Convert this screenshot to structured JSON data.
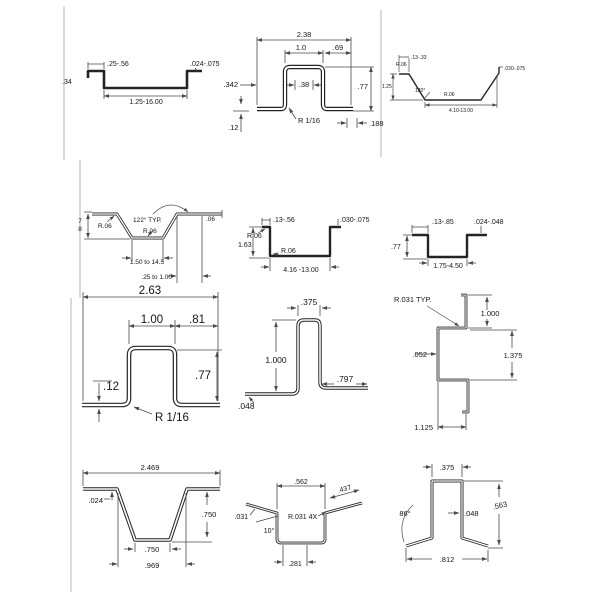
{
  "page": {
    "background": "#ffffff",
    "profile_color": "#242424",
    "dim_color": "#4a4a4a",
    "border_color": "#c6c6c6"
  },
  "cells": {
    "r1c1": {
      "flange_width": ".25-.56",
      "thickness": ".024-.075",
      "lip_height": ".34",
      "bottom_width": "1.25-16.00"
    },
    "r1c2": {
      "overall_width": "2.38",
      "top_width": "1.0",
      "right_offset": ".69",
      "left_offset": ".342",
      "inner_width": ".38",
      "height": ".77",
      "bend_radius": "R 1/16",
      "foot_length": ".188",
      "foot_height": ".12"
    },
    "r1c3": {
      "flange_width": ".13-.33",
      "radius_left": "R.06",
      "height": "1.25",
      "angle": "120°",
      "radius_right": "R.06",
      "thickness": ".030-.075",
      "bottom_width": "4.10-13.00"
    },
    "r2c1": {
      "height_numerator": "7",
      "height_denominator": "8",
      "radius_left": "R.06",
      "angle": "122° TYP.",
      "radius_center": "R.06",
      "thickness": ".06",
      "bottom_width": "1.50 to 14.5",
      "flange_width": ".25 to 1.00"
    },
    "r2c2": {
      "flange_width": ".13-.56",
      "thickness": ".030-.075",
      "radius_left": "R.06",
      "height": "1.63",
      "radius_inner": "R.06",
      "bottom_width": "4.16 -13.00"
    },
    "r2c3": {
      "flange_width": ".13-.85",
      "thickness": ".024-.048",
      "height": ".77",
      "bottom_width": "1.75-4.50"
    },
    "r3c1": {
      "overall_width": "2.63",
      "top_width": "1.00",
      "right_offset": ".81",
      "lip_height": ".12",
      "height": ".77",
      "bend_radius": "R 1/16"
    },
    "r3c2": {
      "top_width": ".375",
      "height": "1.000",
      "flange_length": ".797",
      "thickness": ".048"
    },
    "r3c3": {
      "bend_radius": "R.031 TYP.",
      "top_leg": "1.000",
      "thickness": ".052",
      "height": "1.375",
      "bottom_width": "1.125"
    },
    "r4c1": {
      "overall_width": "2.469",
      "thickness": ".024",
      "height": ".750",
      "bottom_inner": ".750",
      "bottom_outer": ".969"
    },
    "r4c2": {
      "top_width": ".562",
      "flange_length": ".437",
      "thickness": ".031",
      "angle": "10°",
      "bend_radius": "R.031 4X",
      "bottom_width": ".281"
    },
    "r4c3": {
      "top_width": ".375",
      "angle": "86°",
      "thickness": ".048",
      "height": ".563",
      "bottom_width": ".812"
    }
  }
}
